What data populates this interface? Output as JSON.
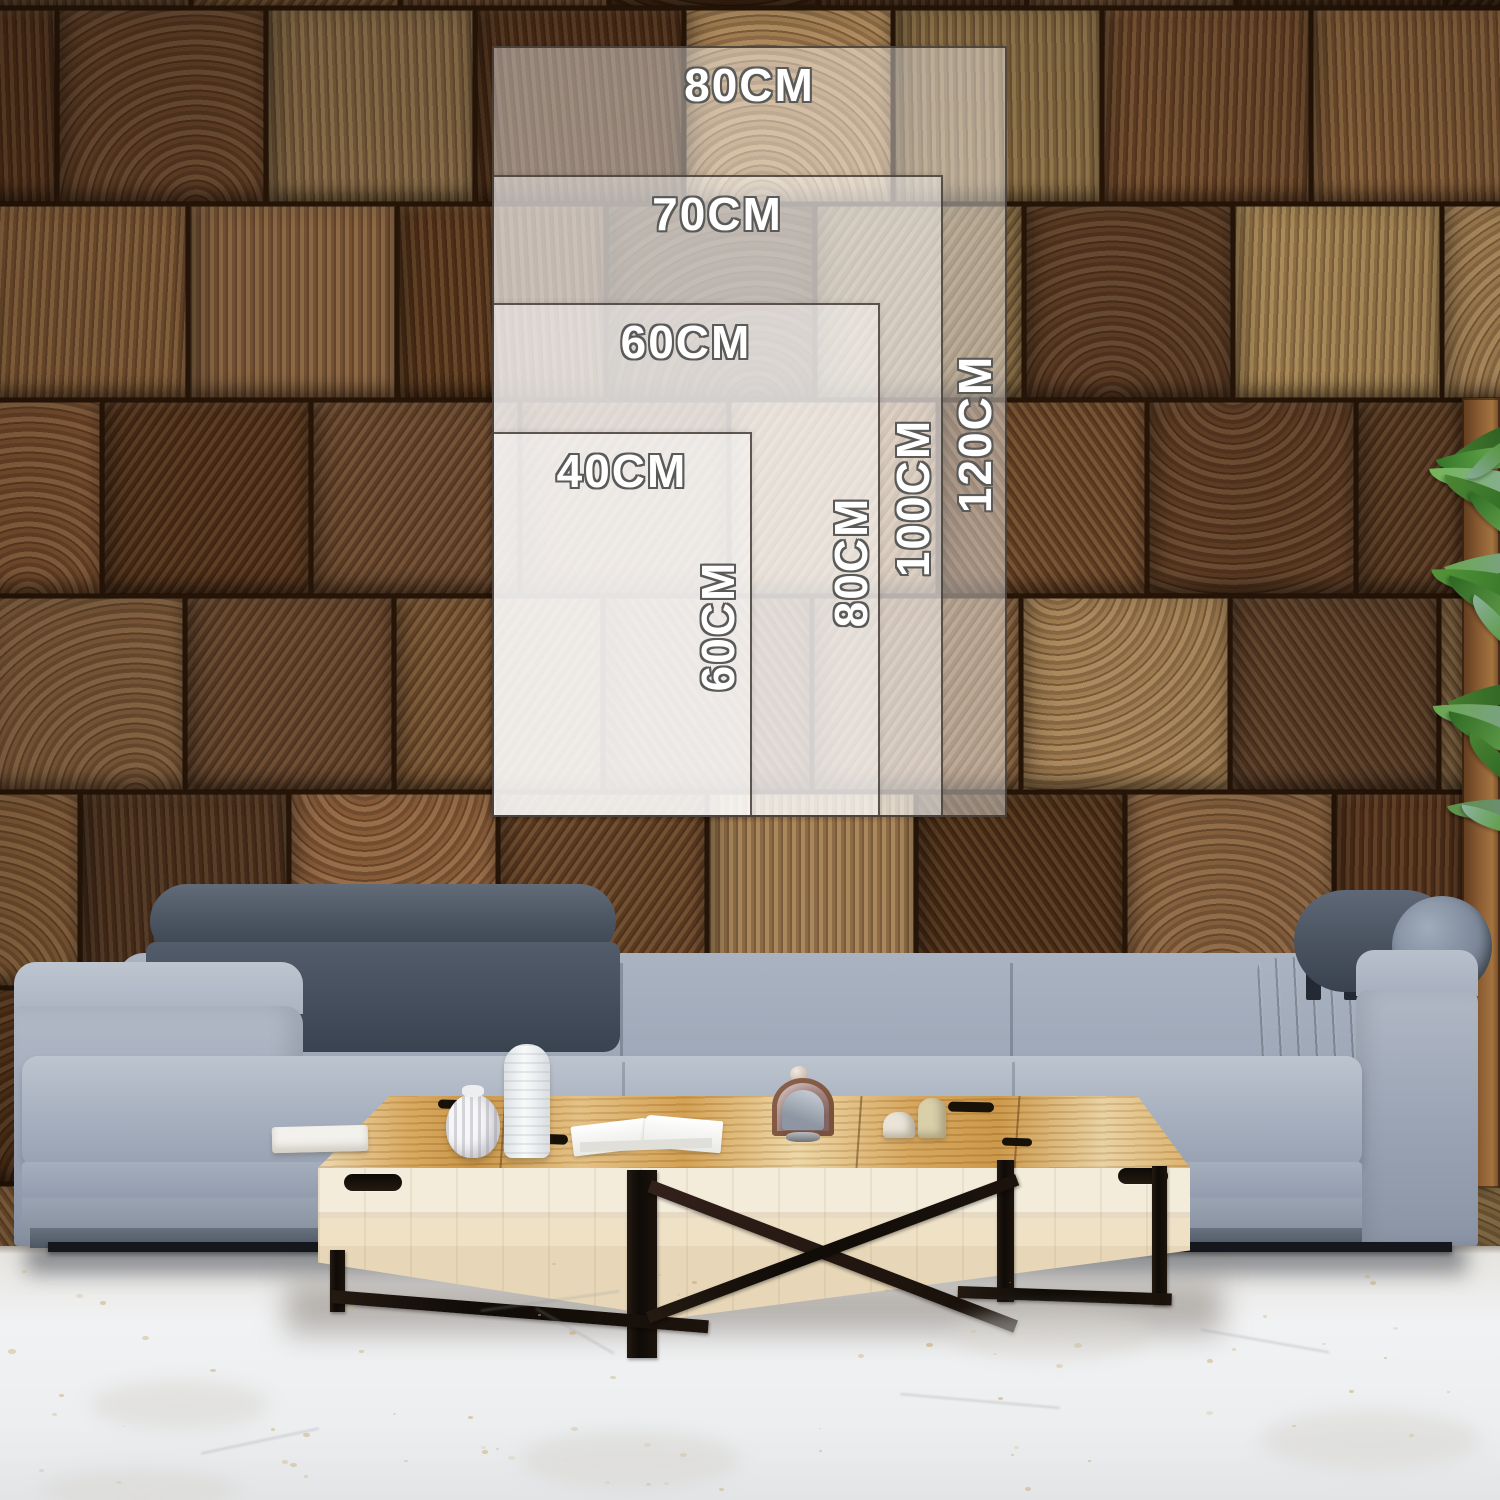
{
  "size_chart": {
    "unit": "CM",
    "options": [
      {
        "width": "80CM",
        "height": "120CM"
      },
      {
        "width": "70CM",
        "height": "100CM"
      },
      {
        "width": "60CM",
        "height": "80CM"
      },
      {
        "width": "40CM",
        "height": "60CM"
      }
    ]
  },
  "scene": {
    "description": "Living room product mockup: end-grain wood block wall with translucent canvas size guides, gray fabric sofa with dark quilted headrests, light wood coffee table with decor objects, plant foliage at right edge, white marble floor",
    "colors": {
      "overlay_fill": "rgba(255,255,255,0.42)",
      "overlay_border": "#38302a",
      "label_text": "#ffffff",
      "label_outline": "#5a5a58",
      "wall_palette": [
        "#7a5533",
        "#6a452a",
        "#845d38",
        "#5d3c24",
        "#9c7a50",
        "#4e3018",
        "#765033",
        "#613f24",
        "#8a6340",
        "#55331b",
        "#a08050",
        "#3f2613"
      ],
      "sofa_fabric": "#a6afbe",
      "headrest_dark": "#49535f",
      "table_top_wood": "#d8a85f",
      "table_front_wood": "#f0e7d2",
      "metal_legs": "#17110c",
      "floor": "#eceef0",
      "plant_greens": [
        "#4e8a35",
        "#2f6b24",
        "#6aa84f",
        "#7fa08f"
      ]
    }
  }
}
